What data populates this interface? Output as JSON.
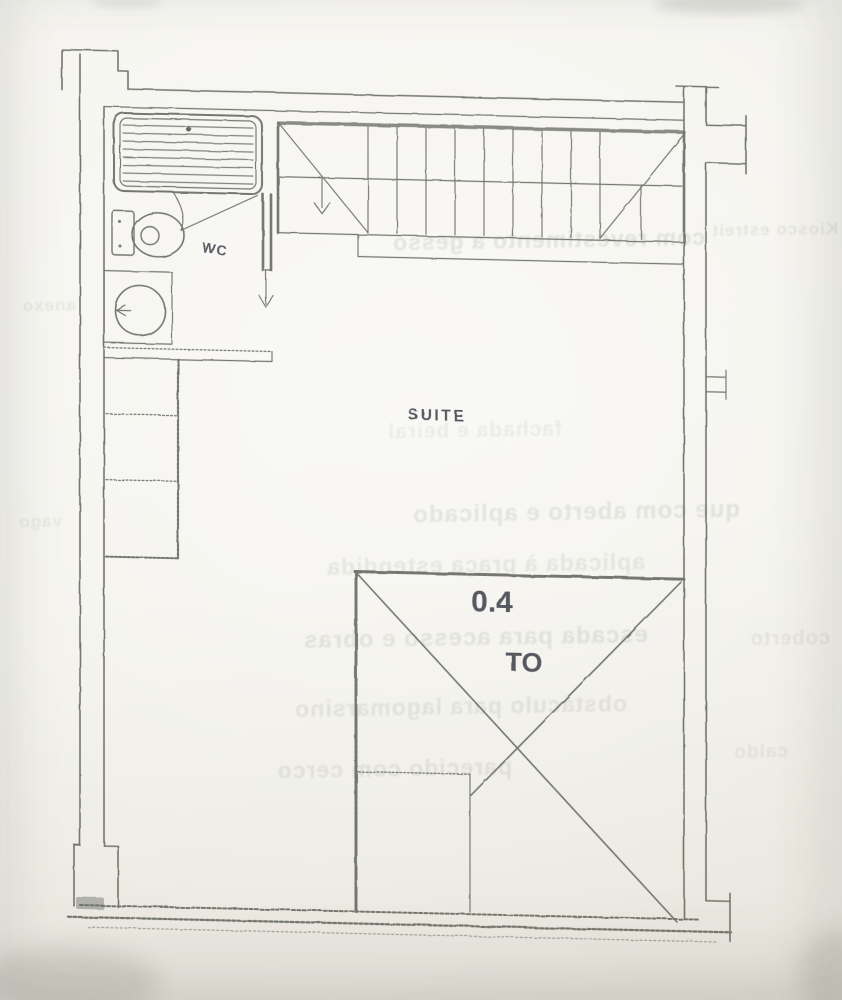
{
  "plan": {
    "room_label": "SUITE",
    "wc_label": "WC",
    "void_dimension": "0.4",
    "void_label": "TO"
  },
  "ghost": {
    "lines": [
      {
        "text": "com revestimento a gesso"
      },
      {
        "text": "Kiosco estreito"
      },
      {
        "text": "fachada e beiral"
      },
      {
        "text": "que com aberto e aplicado"
      },
      {
        "text": "aplicada à praça estendida"
      },
      {
        "text": "escada para acesso e obras"
      },
      {
        "text": "coberto"
      },
      {
        "text": "obstáculo para lagomarsino"
      },
      {
        "text": "parecido com cerco"
      },
      {
        "text": "caldo"
      },
      {
        "text": "anexo"
      },
      {
        "text": "vago"
      }
    ]
  },
  "palette": {
    "paper": "#f3f2ec",
    "pencil": "#666a61",
    "pencil_dark": "#4e524a",
    "label_ink": "#454a51"
  }
}
